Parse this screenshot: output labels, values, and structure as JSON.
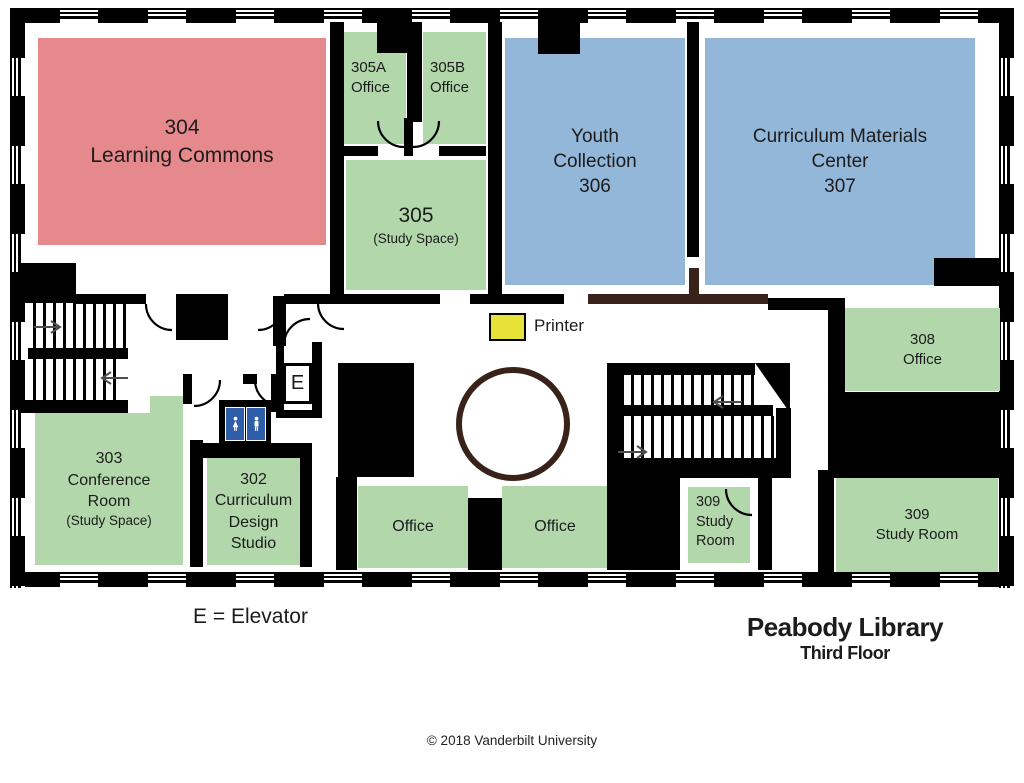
{
  "meta": {
    "title": "Peabody Library",
    "subtitle": "Third Floor",
    "copyright": "© 2018 Vanderbilt University",
    "legend_elevator": "E = Elevator"
  },
  "labels": {
    "printer": "Printer",
    "elevator_letter": "E"
  },
  "colors": {
    "red": "#e5898c",
    "green": "#b2d7ab",
    "blue": "#93b7d8",
    "yellow": "#e7e238",
    "wc": "#2e5da9",
    "wood": "#38221a"
  },
  "rooms": {
    "r304": {
      "lines": [
        "304",
        "Learning Commons"
      ]
    },
    "r305a": {
      "lines": [
        "305A",
        "Office"
      ]
    },
    "r305b": {
      "lines": [
        "305B",
        "Office"
      ]
    },
    "r305": {
      "lines": [
        "305",
        "(Study Space)"
      ]
    },
    "r306": {
      "lines": [
        "Youth",
        "Collection",
        "306"
      ]
    },
    "r307": {
      "lines": [
        "Curriculum Materials",
        "Center",
        "307"
      ]
    },
    "r308": {
      "lines": [
        "308",
        "Office"
      ]
    },
    "r303": {
      "lines": [
        "303",
        "Conference",
        "Room",
        "(Study Space)"
      ]
    },
    "r302": {
      "lines": [
        "302",
        "Curriculum",
        "Design",
        "Studio"
      ]
    },
    "office_left": {
      "lines": [
        "Office"
      ]
    },
    "office_right": {
      "lines": [
        "Office"
      ]
    },
    "r309_small": {
      "lines": [
        "309",
        "Study",
        "Room"
      ]
    },
    "r309_large": {
      "lines": [
        "309",
        "Study Room"
      ]
    }
  }
}
